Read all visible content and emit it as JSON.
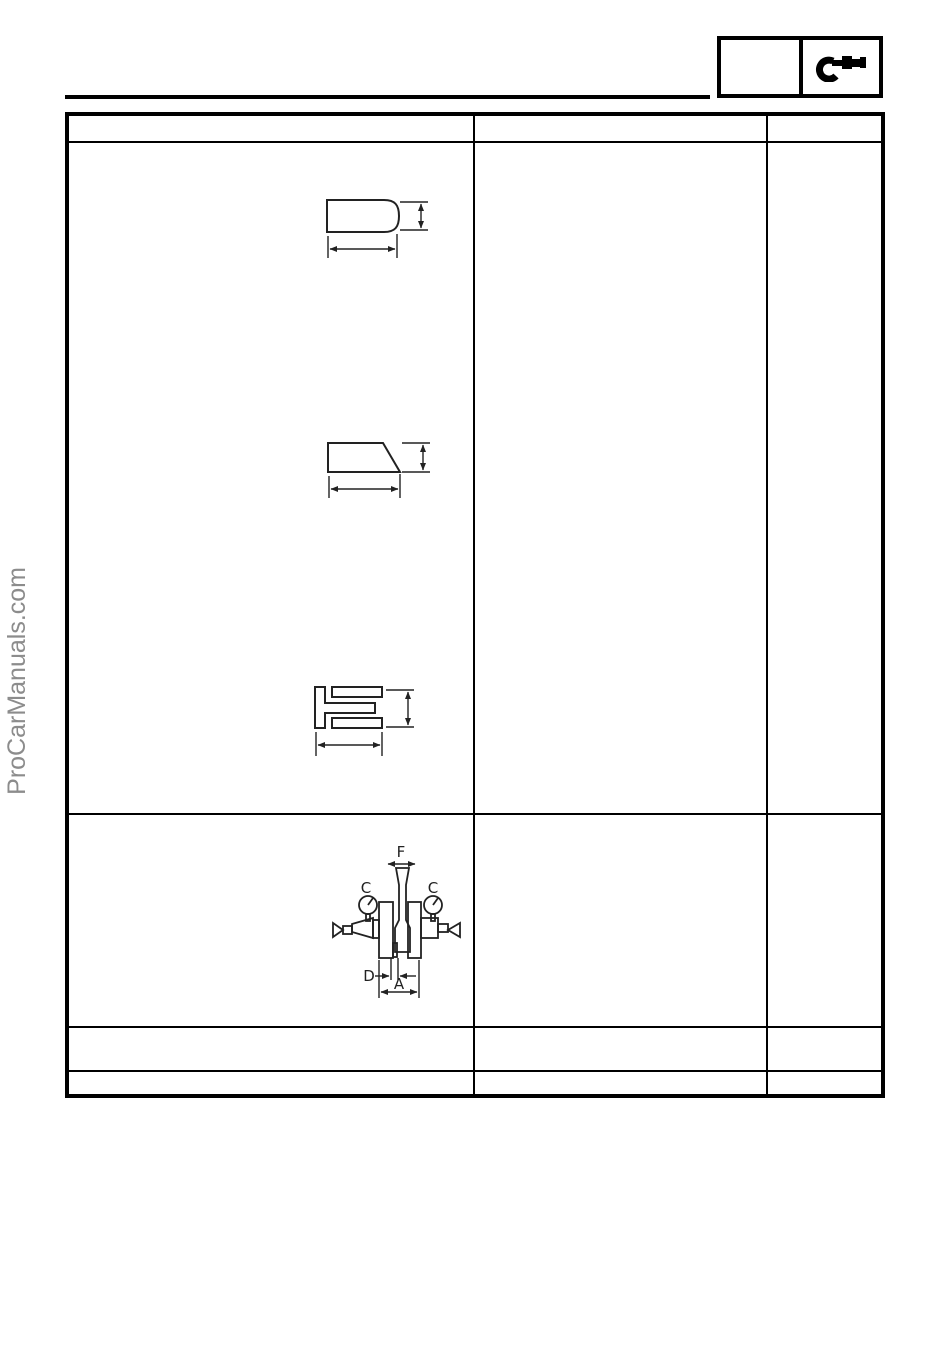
{
  "watermark": {
    "text": "ProCarManuals.com",
    "color": "#8c8c8c"
  },
  "chapter_tab": {
    "icon": "micrometer-icon"
  },
  "table": {
    "columns": 3,
    "rows": 5,
    "note_all_cells_empty": ""
  },
  "diagrams": {
    "top_ring": {
      "icon": "barrel-face-ring-cross-section-icon"
    },
    "second_ring": {
      "icon": "taper-face-ring-cross-section-icon"
    },
    "oil_ring": {
      "icon": "oil-control-ring-cross-section-icon"
    },
    "crankshaft": {
      "icon": "crankshaft-runout-measurement-icon",
      "labels": {
        "f": "F",
        "c_left": "C",
        "c_right": "C",
        "d": "D",
        "a": "A"
      }
    }
  },
  "colors": {
    "table_border": "#000000",
    "diagram_line": "#222222",
    "watermark": "#8c8c8c"
  }
}
